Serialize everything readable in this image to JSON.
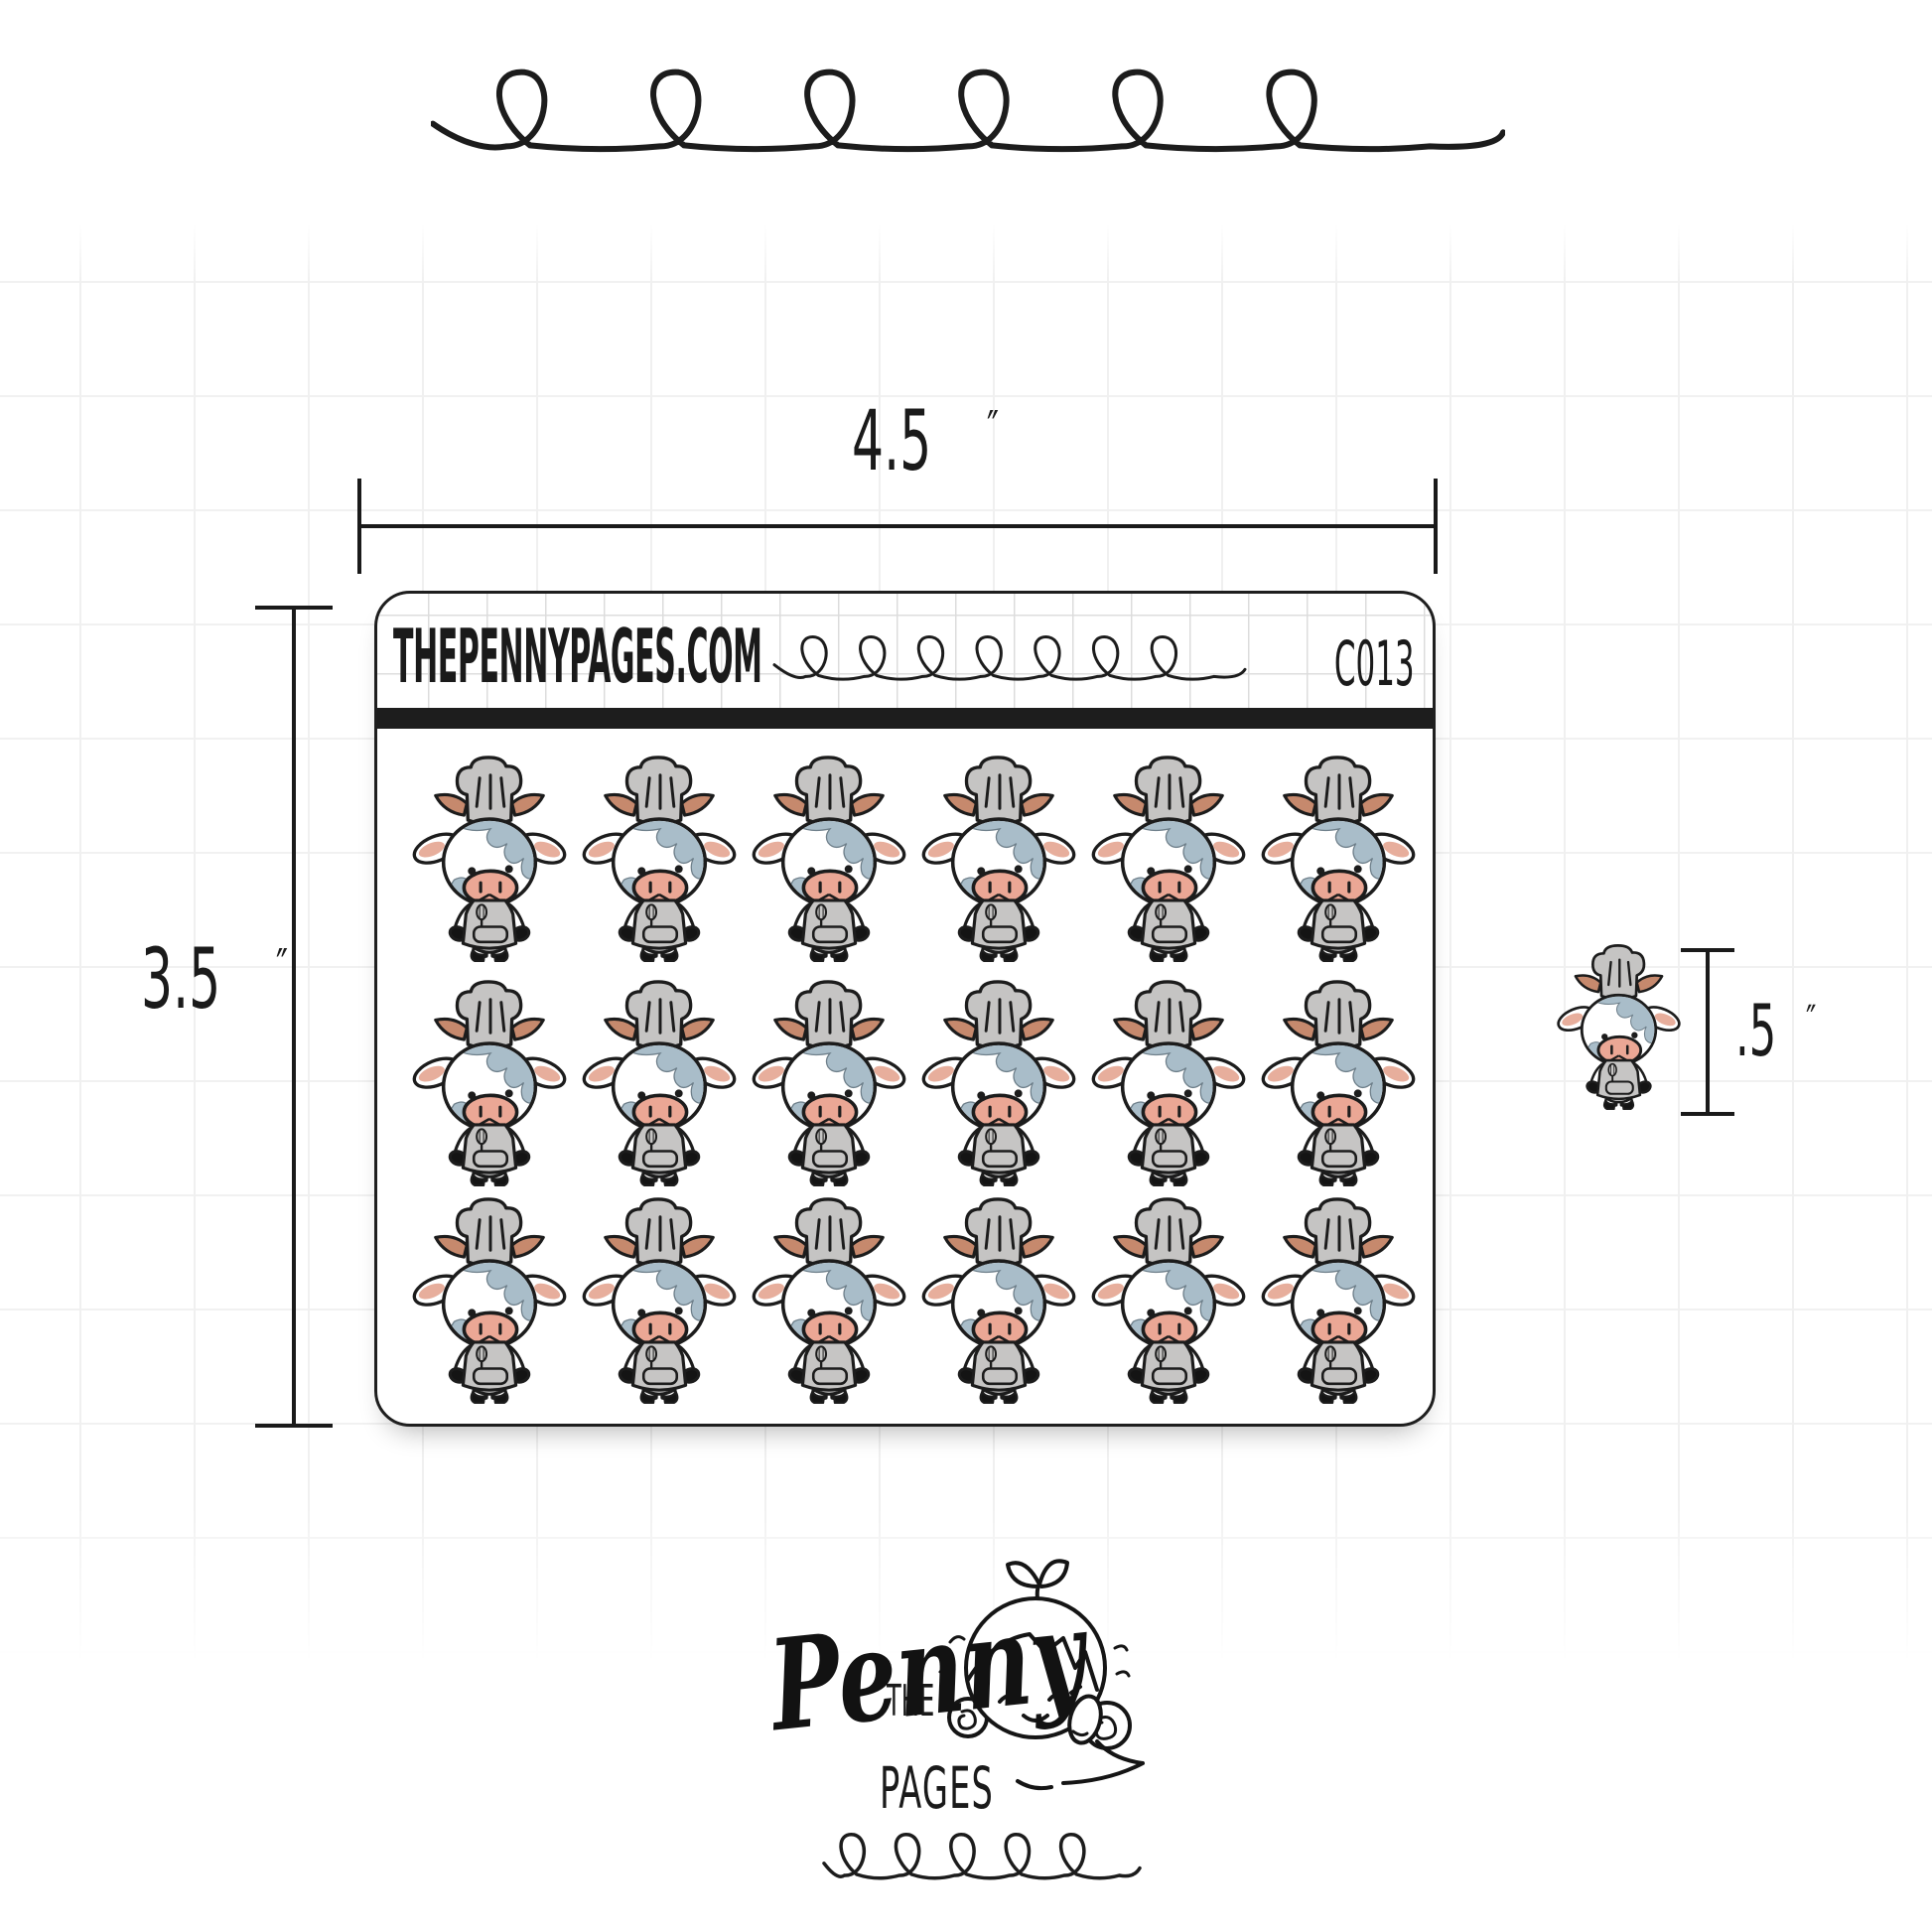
{
  "sheet": {
    "site": "THEPENNYPAGES.COM",
    "code": "C013",
    "rows": 3,
    "columns": 6,
    "sticker_count": 18,
    "bar_color": "#1d1d1d"
  },
  "dimensions": {
    "width": {
      "value": "4.5",
      "unit": "″"
    },
    "height": {
      "value": "3.5",
      "unit": "″"
    },
    "sticker_height": {
      "value": ".5",
      "unit": "″"
    }
  },
  "logo": {
    "the": "THE",
    "name": "Penny",
    "pages": "PAGES"
  },
  "sticker": {
    "name": "chef-cow",
    "description": "white cow with blue-gray patches wearing gray chef hat and apron with whisk and pocket",
    "colors": {
      "outline": "#1c1c1c",
      "hat_gray": "#c5c4c3",
      "apron_gray": "#c6c5c4",
      "patch_blue": "#a9bdc9",
      "horn_brown": "#c6896d",
      "ear_inner_pink": "#e7ae9c",
      "snout_pink": "#eba795",
      "hoof_black": "#141414",
      "body_white": "#ffffff"
    }
  },
  "icons": [
    "loop-doodle-top",
    "loop-doodle-header",
    "loop-doodle-bottom",
    "penny-girl-logo"
  ]
}
